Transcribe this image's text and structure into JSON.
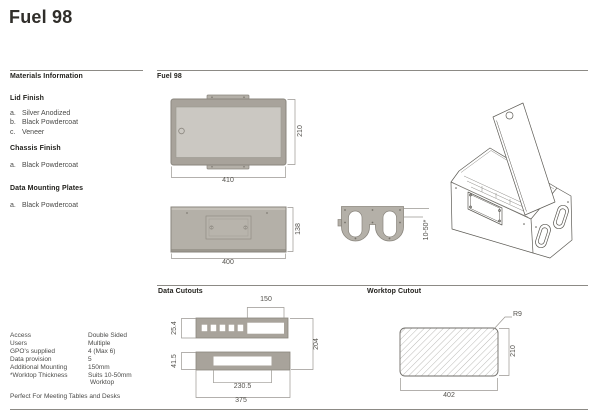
{
  "page": {
    "title": "Fuel 98",
    "footer_note": "Perfect For Meeting Tables and Desks"
  },
  "materials": {
    "heading": "Materials Information",
    "sections": [
      {
        "title": "Lid Finish",
        "options": [
          {
            "key": "a.",
            "label": "Silver Anodized"
          },
          {
            "key": "b.",
            "label": "Black Powdercoat"
          },
          {
            "key": "c.",
            "label": "Veneer"
          }
        ]
      },
      {
        "title": "Chassis Finish",
        "options": [
          {
            "key": "a.",
            "label": "Black Powdercoat"
          }
        ]
      },
      {
        "title": "Data Mounting Plates",
        "options": [
          {
            "key": "a.",
            "label": "Black Powdercoat"
          }
        ]
      }
    ]
  },
  "specs": [
    {
      "label": "Access",
      "value": "Double Sided"
    },
    {
      "label": "Users",
      "value": "Multiple"
    },
    {
      "label": "GPO's supplied",
      "value": "4 (Max 6)"
    },
    {
      "label": "Data provision",
      "value": "5"
    },
    {
      "label": "Additional Mounting",
      "value": "150mm"
    },
    {
      "label": "*Worktop Thickness",
      "value": "Suits 10-50mm"
    },
    {
      "label": "",
      "value": "Worktop"
    }
  ],
  "drawings": {
    "heading": "Fuel 98",
    "top_view": {
      "width": "410",
      "depth": "210"
    },
    "front_view": {
      "width": "400",
      "height": "138"
    },
    "profile": {
      "clamp_range": "10-50*"
    },
    "data_cutouts": {
      "heading": "Data Cutouts",
      "cutout_width": "150",
      "row1_height": "25.4",
      "row2_height": "41.5",
      "overall_height": "204",
      "row2_width": "230.5",
      "overall_width": "375"
    },
    "worktop_cutout": {
      "heading": "Worktop Cutout",
      "corner_radius": "R9",
      "depth": "210",
      "width": "402"
    }
  },
  "colors": {
    "panel_light": "#cbc8c2",
    "panel_mid": "#b4b0a8",
    "panel_dark": "#a8a39b",
    "outline": "#8a867e",
    "dimension": "#9a9792",
    "rule": "#8c8a85",
    "text_dark": "#23221e",
    "text_body": "#4a4a48",
    "dim_text": "#54524d"
  }
}
